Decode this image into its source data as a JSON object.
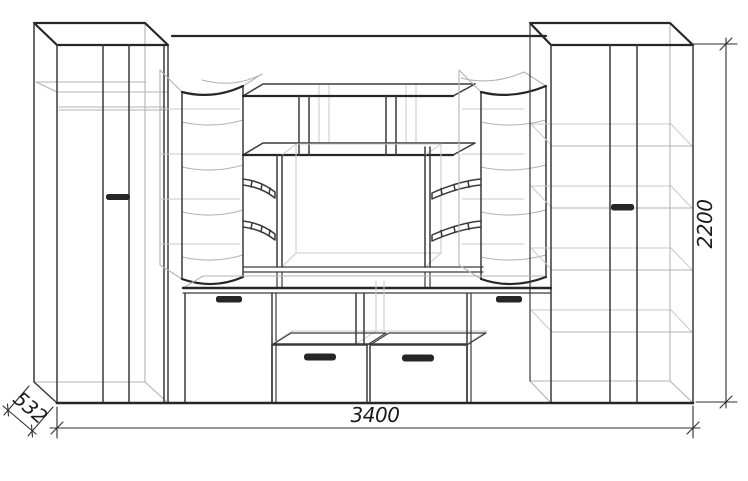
{
  "drawing": {
    "dimension_labels": {
      "width": "3400",
      "height": "2200",
      "depth": "532"
    },
    "colors": {
      "background": "#ffffff",
      "main_line": "#262626",
      "secondary_line": "#3a3a3a",
      "interior_line": "#b3b3b3",
      "dimension_text": "#1c1c1c"
    }
  }
}
